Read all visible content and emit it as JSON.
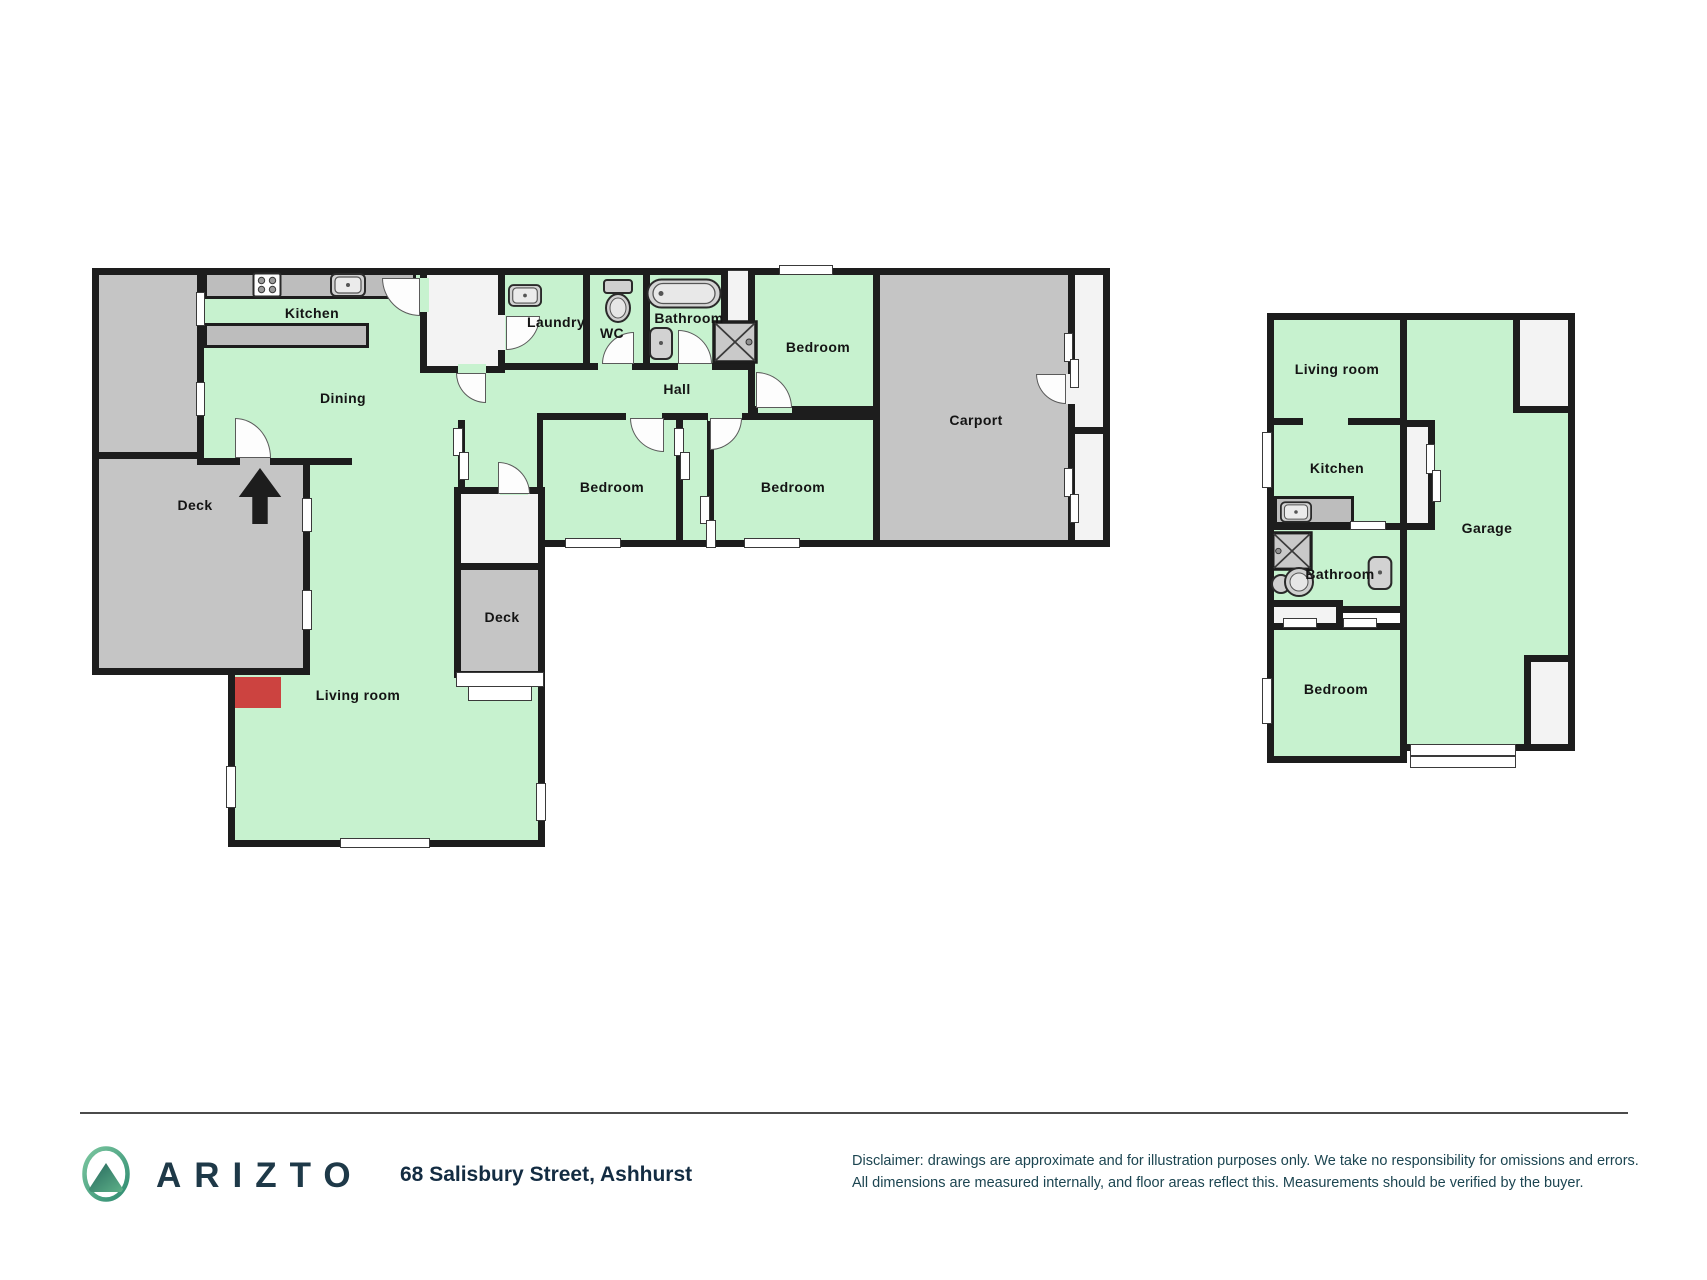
{
  "plan": {
    "colors": {
      "room_green": "#c7f2cf",
      "deck_gray": "#c5c5c5",
      "light_area": "#f3f3f3",
      "wall_dark": "#1d1d1d",
      "fireplace_red": "#cc4340"
    },
    "main_building": {
      "labels": {
        "kitchen": "Kitchen",
        "dining": "Dining",
        "deck_left": "Deck",
        "laundry": "Laundry",
        "wc": "WC",
        "bathroom": "Bathroom",
        "bedroom_top": "Bedroom",
        "hall": "Hall",
        "bedroom_center": "Bedroom",
        "bedroom_right": "Bedroom",
        "carport": "Carport",
        "deck_right": "Deck",
        "living_room": "Living room"
      }
    },
    "secondary_building": {
      "labels": {
        "living_room": "Living room",
        "kitchen": "Kitchen",
        "bathroom": "Bathroom",
        "bedroom": "Bedroom",
        "garage": "Garage"
      }
    },
    "icons": {
      "north_arrow": "north-arrow-icon",
      "stove": "stove-icon",
      "sink": "sink-icon",
      "toilet": "toilet-icon",
      "bathtub": "bathtub-icon",
      "shower": "shower-icon",
      "fireplace": "fireplace-marker",
      "garage_door": "garage-door-marker"
    }
  },
  "footer": {
    "brand": "ARIZTO",
    "address": "68 Salisbury Street, Ashhurst",
    "disclaimer_line1": "Disclaimer: drawings are approximate and for illustration purposes only. We take no responsibility for omissions and errors.",
    "disclaimer_line2": "All dimensions are measured internally, and floor areas reflect this. Measurements should be verified by the buyer."
  }
}
